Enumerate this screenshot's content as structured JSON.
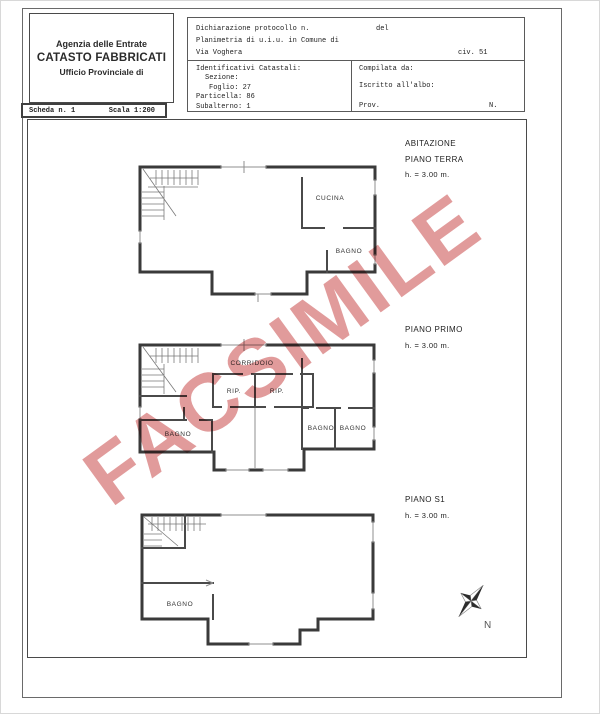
{
  "header_box": {
    "line1": "Agenzia delle Entrate",
    "line2": "CATASTO FABBRICATI",
    "line3": "Ufficio Provinciale di"
  },
  "scheda_strip": {
    "scheda": "Scheda n. 1",
    "scala": "Scala 1:200"
  },
  "form": {
    "dichiarazione": "Dichiarazione protocollo n.",
    "del": "del",
    "planimetria": "Planimetria di u.i.u. in Comune di",
    "via": "Via Voghera",
    "civ": "civ. 51",
    "identificativi": "Identificativi Catastali:",
    "sezione": "Sezione:",
    "foglio": "Foglio: 27",
    "particella": "Particella: 86",
    "subalterno": "Subalterno: 1",
    "compilata": "Compilata da:",
    "iscritto": "Iscritto all'albo:",
    "prov": "Prov.",
    "n": "N."
  },
  "floors": {
    "terra": {
      "title1": "ABITAZIONE",
      "title2": "PIANO TERRA",
      "height": "h. = 3.00 m.",
      "rooms": {
        "cucina": "CUCINA",
        "bagno": "BAGNO"
      }
    },
    "primo": {
      "title": "PIANO PRIMO",
      "height": "h. = 3.00 m.",
      "rooms": {
        "corridoio": "CORRIDOIO",
        "rip1": "RIP.",
        "rip2": "RIP.",
        "bagno_left": "BAGNO",
        "bagno_mid": "BAGNO",
        "bagno_right": "BAGNO"
      }
    },
    "s1": {
      "title": "PIANO S1",
      "height": "h. = 3.00 m.",
      "rooms": {
        "bagno": "BAGNO"
      }
    }
  },
  "watermark": {
    "text": "FACSIMILE",
    "color": "#dc8a8a"
  },
  "compass": {
    "label": "N"
  },
  "scale": "1:200"
}
